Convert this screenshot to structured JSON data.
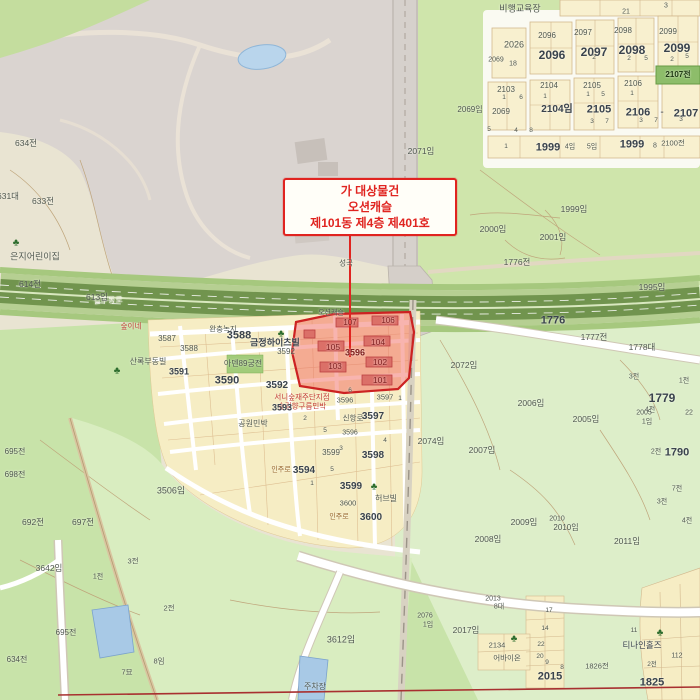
{
  "annotation": {
    "line1": "가 대상물건",
    "line2": "오션캐슬",
    "line3": "제101동 제4층 제401호"
  },
  "highlight": {
    "parcel_number": "3596",
    "building_units": [
      "101",
      "102",
      "103",
      "104",
      "105",
      "106",
      "107"
    ],
    "complex_name": "오션캐슬"
  },
  "colors": {
    "annotation_red": "#e02420",
    "highlight_fill": "#f2695f",
    "highlight_border": "#cc2222",
    "forest_green": "#c8e3a9",
    "light_green": "#ddeec9",
    "residential_yellow": "#f6edc4",
    "park_gray": "#dad4d0",
    "expressway_green": "#71944e",
    "water_blue": "#a8c9e6"
  },
  "palette": {
    "g": "#4f574f",
    "d": "#3a434d",
    "m": "#7d1f1f",
    "r": "#c23b36",
    "w": "#f4f3ea",
    "o": "#96652e",
    "k": "#203a14"
  },
  "trees": [
    {
      "x": 16,
      "y": 243
    },
    {
      "x": 281,
      "y": 334
    },
    {
      "x": 117,
      "y": 371
    },
    {
      "x": 374,
      "y": 487
    },
    {
      "x": 660,
      "y": 633
    },
    {
      "x": 514,
      "y": 639
    }
  ],
  "labels": [
    {
      "t": "비행교육장",
      "x": 520,
      "y": 9,
      "s": 9,
      "n": "poi-label"
    },
    {
      "t": "21",
      "x": 626,
      "y": 12,
      "s": 7
    },
    {
      "t": "3",
      "x": 666,
      "y": 6,
      "s": 7
    },
    {
      "t": "2096",
      "x": 547,
      "y": 36,
      "s": 8
    },
    {
      "t": "2096",
      "x": 552,
      "y": 55,
      "s": 12,
      "c": "d",
      "b": 1
    },
    {
      "t": "2097",
      "x": 583,
      "y": 33,
      "s": 8
    },
    {
      "t": "2097",
      "x": 594,
      "y": 52,
      "s": 12,
      "c": "d",
      "b": 1
    },
    {
      "t": "2098",
      "x": 623,
      "y": 31,
      "s": 8
    },
    {
      "t": "2098",
      "x": 632,
      "y": 50,
      "s": 12,
      "c": "d",
      "b": 1
    },
    {
      "t": "2099",
      "x": 668,
      "y": 32,
      "s": 8
    },
    {
      "t": "2099",
      "x": 677,
      "y": 48,
      "s": 12,
      "c": "d",
      "b": 1
    },
    {
      "t": "2026",
      "x": 514,
      "y": 45,
      "s": 9
    },
    {
      "t": "2069",
      "x": 496,
      "y": 60,
      "s": 7
    },
    {
      "t": "18",
      "x": 513,
      "y": 64,
      "s": 7
    },
    {
      "t": "2",
      "x": 594,
      "y": 58,
      "s": 6.5
    },
    {
      "t": "2",
      "x": 629,
      "y": 59,
      "s": 6.5
    },
    {
      "t": "5",
      "x": 646,
      "y": 59,
      "s": 6.5
    },
    {
      "t": "2",
      "x": 672,
      "y": 60,
      "s": 6.5
    },
    {
      "t": "5",
      "x": 687,
      "y": 57,
      "s": 6.5
    },
    {
      "t": "2069임",
      "x": 470,
      "y": 110,
      "s": 8
    },
    {
      "t": "2069",
      "x": 501,
      "y": 112,
      "s": 8
    },
    {
      "t": "2103",
      "x": 506,
      "y": 90,
      "s": 8
    },
    {
      "t": "2104",
      "x": 549,
      "y": 86,
      "s": 8
    },
    {
      "t": "2105",
      "x": 592,
      "y": 86,
      "s": 8
    },
    {
      "t": "2106",
      "x": 633,
      "y": 84,
      "s": 8
    },
    {
      "t": "2107전",
      "x": 678,
      "y": 75,
      "s": 8,
      "c": "k",
      "b": 1
    },
    {
      "t": "2104임",
      "x": 557,
      "y": 110,
      "s": 10,
      "c": "d",
      "b": 1
    },
    {
      "t": "2105",
      "x": 599,
      "y": 110,
      "s": 11,
      "c": "d",
      "b": 1
    },
    {
      "t": "2106",
      "x": 638,
      "y": 113,
      "s": 11,
      "c": "d",
      "b": 1
    },
    {
      "t": "-",
      "x": 662,
      "y": 113,
      "s": 10,
      "c": "d"
    },
    {
      "t": "2107",
      "x": 686,
      "y": 114,
      "s": 11,
      "c": "d",
      "b": 1
    },
    {
      "t": "1",
      "x": 504,
      "y": 98,
      "s": 6.5
    },
    {
      "t": "6",
      "x": 521,
      "y": 98,
      "s": 6.5
    },
    {
      "t": "1",
      "x": 545,
      "y": 97,
      "s": 6.5
    },
    {
      "t": "1",
      "x": 588,
      "y": 95,
      "s": 6.5
    },
    {
      "t": "5",
      "x": 603,
      "y": 95,
      "s": 6.5
    },
    {
      "t": "1",
      "x": 632,
      "y": 94,
      "s": 6.5
    },
    {
      "t": "3",
      "x": 592,
      "y": 122,
      "s": 6.5
    },
    {
      "t": "7",
      "x": 607,
      "y": 122,
      "s": 6.5
    },
    {
      "t": "3",
      "x": 641,
      "y": 121,
      "s": 6.5
    },
    {
      "t": "7",
      "x": 656,
      "y": 121,
      "s": 6.5
    },
    {
      "t": "3",
      "x": 681,
      "y": 120,
      "s": 6.5
    },
    {
      "t": "5",
      "x": 489,
      "y": 130,
      "s": 6.5
    },
    {
      "t": "4",
      "x": 516,
      "y": 131,
      "s": 6.5
    },
    {
      "t": "8",
      "x": 531,
      "y": 131,
      "s": 6.5
    },
    {
      "t": "1",
      "x": 506,
      "y": 147,
      "s": 6.5
    },
    {
      "t": "1999",
      "x": 548,
      "y": 148,
      "s": 11,
      "c": "d",
      "b": 1
    },
    {
      "t": "4임",
      "x": 570,
      "y": 147,
      "s": 7
    },
    {
      "t": "5임",
      "x": 592,
      "y": 147,
      "s": 7
    },
    {
      "t": "1999",
      "x": 632,
      "y": 145,
      "s": 11,
      "c": "d",
      "b": 1
    },
    {
      "t": "8",
      "x": 655,
      "y": 146,
      "s": 7
    },
    {
      "t": "2100전",
      "x": 673,
      "y": 143,
      "s": 7.5
    },
    {
      "t": "2071임",
      "x": 421,
      "y": 151,
      "s": 8.5
    },
    {
      "t": "1999임",
      "x": 574,
      "y": 209,
      "s": 8.5
    },
    {
      "t": "2000임",
      "x": 493,
      "y": 229,
      "s": 8.5
    },
    {
      "t": "2001임",
      "x": 553,
      "y": 237,
      "s": 8.5
    },
    {
      "t": "1776전",
      "x": 517,
      "y": 262,
      "s": 8.5
    },
    {
      "t": "1995임",
      "x": 652,
      "y": 287,
      "s": 8.5
    },
    {
      "t": "1776",
      "x": 553,
      "y": 321,
      "s": 11,
      "c": "d",
      "b": 1
    },
    {
      "t": "1777전",
      "x": 594,
      "y": 337,
      "s": 8.5
    },
    {
      "t": "1778대",
      "x": 642,
      "y": 347,
      "s": 8.5
    },
    {
      "t": "2072임",
      "x": 464,
      "y": 365,
      "s": 8.5
    },
    {
      "t": "3전",
      "x": 634,
      "y": 377,
      "s": 7
    },
    {
      "t": "1전",
      "x": 684,
      "y": 381,
      "s": 7
    },
    {
      "t": "1779",
      "x": 662,
      "y": 398,
      "s": 12,
      "c": "d",
      "b": 1
    },
    {
      "t": "4전",
      "x": 650,
      "y": 410,
      "s": 7
    },
    {
      "t": "22",
      "x": 689,
      "y": 413,
      "s": 7
    },
    {
      "t": "2074임",
      "x": 431,
      "y": 441,
      "s": 8.5
    },
    {
      "t": "2006임",
      "x": 531,
      "y": 403,
      "s": 8.5
    },
    {
      "t": "2005임",
      "x": 586,
      "y": 419,
      "s": 8.5
    },
    {
      "t": "2005",
      "x": 644,
      "y": 413,
      "s": 7
    },
    {
      "t": "1임",
      "x": 647,
      "y": 422,
      "s": 7
    },
    {
      "t": "2007임",
      "x": 482,
      "y": 450,
      "s": 8.5
    },
    {
      "t": "2전",
      "x": 656,
      "y": 452,
      "s": 7
    },
    {
      "t": "1790",
      "x": 677,
      "y": 453,
      "s": 11,
      "c": "d",
      "b": 1
    },
    {
      "t": "2008임",
      "x": 488,
      "y": 539,
      "s": 8.5
    },
    {
      "t": "2009임",
      "x": 524,
      "y": 522,
      "s": 8.5
    },
    {
      "t": "2010",
      "x": 557,
      "y": 519,
      "s": 7
    },
    {
      "t": "2010임",
      "x": 566,
      "y": 528,
      "s": 8
    },
    {
      "t": "2011임",
      "x": 627,
      "y": 541,
      "s": 8.5
    },
    {
      "t": "7전",
      "x": 677,
      "y": 489,
      "s": 7
    },
    {
      "t": "3전",
      "x": 662,
      "y": 502,
      "s": 7
    },
    {
      "t": "4전",
      "x": 687,
      "y": 521,
      "s": 7
    },
    {
      "t": "일주동로",
      "x": 108,
      "y": 301,
      "s": 8,
      "c": "w",
      "r": -3,
      "n": "road-label"
    },
    {
      "t": "성곡",
      "x": 346,
      "y": 263,
      "s": 7.5
    },
    {
      "t": "오션캐슬",
      "x": 331,
      "y": 313,
      "s": 7
    },
    {
      "t": "107",
      "x": 350,
      "y": 323,
      "s": 8,
      "c": "m"
    },
    {
      "t": "106",
      "x": 388,
      "y": 321,
      "s": 8,
      "c": "m"
    },
    {
      "t": "105",
      "x": 333,
      "y": 347,
      "s": 8.5,
      "c": "m"
    },
    {
      "t": "104",
      "x": 378,
      "y": 342,
      "s": 8.5,
      "c": "m"
    },
    {
      "t": "3596",
      "x": 355,
      "y": 353,
      "s": 9,
      "c": "m",
      "b": 1
    },
    {
      "t": "103",
      "x": 335,
      "y": 367,
      "s": 8,
      "c": "m"
    },
    {
      "t": "102",
      "x": 380,
      "y": 362,
      "s": 8.5,
      "c": "m"
    },
    {
      "t": "101",
      "x": 380,
      "y": 380,
      "s": 8.5,
      "c": "m"
    },
    {
      "t": "완충녹지",
      "x": 223,
      "y": 329,
      "s": 7.5
    },
    {
      "t": "3587",
      "x": 167,
      "y": 339,
      "s": 8
    },
    {
      "t": "3588",
      "x": 189,
      "y": 349,
      "s": 8
    },
    {
      "t": "3588",
      "x": 239,
      "y": 336,
      "s": 11,
      "c": "d",
      "b": 1
    },
    {
      "t": "금정하이츠빌",
      "x": 275,
      "y": 343,
      "s": 9,
      "c": "d",
      "b": 1
    },
    {
      "t": "3592",
      "x": 286,
      "y": 352,
      "s": 8
    },
    {
      "t": "아덴89궁전",
      "x": 243,
      "y": 364,
      "s": 8
    },
    {
      "t": "산록부동빌",
      "x": 148,
      "y": 362,
      "s": 8
    },
    {
      "t": "3591",
      "x": 179,
      "y": 372,
      "s": 9,
      "c": "d",
      "b": 1
    },
    {
      "t": "3590",
      "x": 227,
      "y": 381,
      "s": 11,
      "c": "d",
      "b": 1
    },
    {
      "t": "3592",
      "x": 277,
      "y": 386,
      "s": 10,
      "c": "d",
      "b": 1
    },
    {
      "t": "서니숲재주단지점",
      "x": 302,
      "y": 397,
      "s": 7.5,
      "c": "r"
    },
    {
      "t": "숲길향구름민박",
      "x": 302,
      "y": 406,
      "s": 7.5,
      "c": "r"
    },
    {
      "t": "3593",
      "x": 282,
      "y": 408,
      "s": 9,
      "c": "d",
      "b": 1
    },
    {
      "t": "공원민박",
      "x": 253,
      "y": 424,
      "s": 8,
      "n": "poi-label"
    },
    {
      "t": "3596",
      "x": 345,
      "y": 400,
      "s": 7.5
    },
    {
      "t": "3597",
      "x": 385,
      "y": 397,
      "s": 7.5
    },
    {
      "t": "신항로",
      "x": 353,
      "y": 418,
      "s": 7.5
    },
    {
      "t": "3597",
      "x": 373,
      "y": 417,
      "s": 10,
      "c": "d",
      "b": 1
    },
    {
      "t": "3596",
      "x": 350,
      "y": 433,
      "s": 7
    },
    {
      "t": "3599",
      "x": 331,
      "y": 453,
      "s": 8
    },
    {
      "t": "3598",
      "x": 373,
      "y": 456,
      "s": 10,
      "c": "d",
      "b": 1
    },
    {
      "t": "인주로",
      "x": 281,
      "y": 470,
      "s": 7,
      "c": "o"
    },
    {
      "t": "3594",
      "x": 304,
      "y": 471,
      "s": 10,
      "c": "d",
      "b": 1
    },
    {
      "t": "3599",
      "x": 351,
      "y": 487,
      "s": 10,
      "c": "d",
      "b": 1
    },
    {
      "t": "허브빌",
      "x": 386,
      "y": 499,
      "s": 8
    },
    {
      "t": "3600",
      "x": 348,
      "y": 503,
      "s": 7.5
    },
    {
      "t": "인주로",
      "x": 339,
      "y": 517,
      "s": 7,
      "c": "o"
    },
    {
      "t": "3600",
      "x": 371,
      "y": 518,
      "s": 10,
      "c": "d",
      "b": 1
    },
    {
      "t": "6",
      "x": 350,
      "y": 391,
      "s": 6.5
    },
    {
      "t": "1",
      "x": 400,
      "y": 399,
      "s": 6.5
    },
    {
      "t": "2",
      "x": 305,
      "y": 419,
      "s": 6.5
    },
    {
      "t": "5",
      "x": 325,
      "y": 431,
      "s": 6.5
    },
    {
      "t": "3",
      "x": 341,
      "y": 449,
      "s": 6.5
    },
    {
      "t": "4",
      "x": 385,
      "y": 441,
      "s": 6.5
    },
    {
      "t": "1",
      "x": 312,
      "y": 484,
      "s": 6.5
    },
    {
      "t": "5",
      "x": 332,
      "y": 470,
      "s": 6.5
    },
    {
      "t": "634전",
      "x": 26,
      "y": 143,
      "s": 8.5
    },
    {
      "t": "631대",
      "x": 8,
      "y": 196,
      "s": 8.5
    },
    {
      "t": "633전",
      "x": 43,
      "y": 201,
      "s": 8.5
    },
    {
      "t": "은지어린이집",
      "x": 35,
      "y": 257,
      "s": 9,
      "n": "poi-label"
    },
    {
      "t": "614전",
      "x": 30,
      "y": 284,
      "s": 8.5
    },
    {
      "t": "613임",
      "x": 97,
      "y": 297,
      "s": 8.5
    },
    {
      "t": "숲이네",
      "x": 131,
      "y": 326,
      "s": 7.5,
      "c": "r"
    },
    {
      "t": "695전",
      "x": 15,
      "y": 452,
      "s": 8
    },
    {
      "t": "698전",
      "x": 15,
      "y": 475,
      "s": 8
    },
    {
      "t": "692전",
      "x": 33,
      "y": 522,
      "s": 8.5
    },
    {
      "t": "697전",
      "x": 83,
      "y": 522,
      "s": 8.5
    },
    {
      "t": "3506임",
      "x": 171,
      "y": 491,
      "s": 9
    },
    {
      "t": "3전",
      "x": 133,
      "y": 561,
      "s": 7.5
    },
    {
      "t": "1전",
      "x": 98,
      "y": 577,
      "s": 7
    },
    {
      "t": "3642임",
      "x": 49,
      "y": 568,
      "s": 8.5
    },
    {
      "t": "2전",
      "x": 169,
      "y": 608,
      "s": 7.5
    },
    {
      "t": "695전",
      "x": 66,
      "y": 633,
      "s": 8
    },
    {
      "t": "634전",
      "x": 17,
      "y": 660,
      "s": 8
    },
    {
      "t": "8임",
      "x": 159,
      "y": 661,
      "s": 7.5
    },
    {
      "t": "7묘",
      "x": 127,
      "y": 672,
      "s": 7.5
    },
    {
      "t": "3612임",
      "x": 341,
      "y": 640,
      "s": 9
    },
    {
      "t": "2076",
      "x": 425,
      "y": 616,
      "s": 7
    },
    {
      "t": "1임",
      "x": 428,
      "y": 625,
      "s": 7
    },
    {
      "t": "2017임",
      "x": 466,
      "y": 630,
      "s": 8.5
    },
    {
      "t": "2013",
      "x": 493,
      "y": 599,
      "s": 7
    },
    {
      "t": "8대",
      "x": 499,
      "y": 607,
      "s": 7
    },
    {
      "t": "2134",
      "x": 497,
      "y": 645,
      "s": 7.5
    },
    {
      "t": "어바이온",
      "x": 507,
      "y": 658,
      "s": 7.5
    },
    {
      "t": "주차장",
      "x": 315,
      "y": 687,
      "s": 8
    },
    {
      "t": "티나인홀즈",
      "x": 642,
      "y": 645,
      "s": 8.5,
      "c": "d",
      "n": "poi-label"
    },
    {
      "t": "1825",
      "x": 652,
      "y": 683,
      "s": 11,
      "c": "d",
      "b": 1
    },
    {
      "t": "1826전",
      "x": 597,
      "y": 666,
      "s": 7.5
    },
    {
      "t": "112",
      "x": 677,
      "y": 656,
      "s": 7
    },
    {
      "t": "2015",
      "x": 550,
      "y": 677,
      "s": 11,
      "c": "d",
      "b": 1
    },
    {
      "t": "17",
      "x": 549,
      "y": 611,
      "s": 6.5
    },
    {
      "t": "14",
      "x": 545,
      "y": 629,
      "s": 6.5
    },
    {
      "t": "22",
      "x": 541,
      "y": 645,
      "s": 6.5
    },
    {
      "t": "20",
      "x": 540,
      "y": 657,
      "s": 6.5
    },
    {
      "t": "9",
      "x": 547,
      "y": 663,
      "s": 6.5
    },
    {
      "t": "8",
      "x": 562,
      "y": 668,
      "s": 6.5
    },
    {
      "t": "11",
      "x": 634,
      "y": 631,
      "s": 6.5
    },
    {
      "t": "2전",
      "x": 652,
      "y": 665,
      "s": 6.5
    }
  ]
}
